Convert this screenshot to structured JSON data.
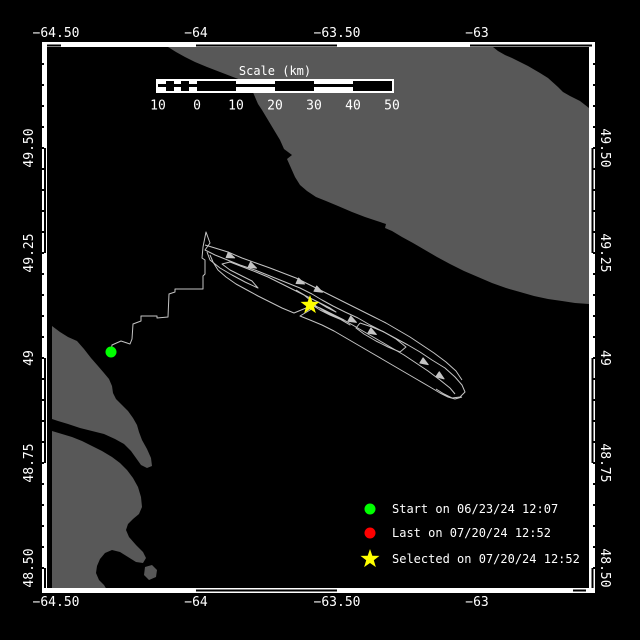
{
  "colors": {
    "background": "#000000",
    "sea": "#000000",
    "land": "#585858",
    "frame": "#ffffff",
    "track": "#c4c4c4",
    "text": "#ffffff",
    "start_marker": "#00ff00",
    "last_marker": "#ff0000",
    "selected_marker": "#ffff00"
  },
  "axes": {
    "top": [
      {
        "label": "−64.50",
        "x": 56
      },
      {
        "label": "−64",
        "x": 196
      },
      {
        "label": "−63.50",
        "x": 337
      },
      {
        "label": "−63",
        "x": 477
      }
    ],
    "bottom": [
      {
        "label": "−64.50",
        "x": 56
      },
      {
        "label": "−64",
        "x": 196
      },
      {
        "label": "−63.50",
        "x": 337
      },
      {
        "label": "−63",
        "x": 477
      }
    ],
    "left": [
      {
        "label": "49.50",
        "y": 148
      },
      {
        "label": "49.25",
        "y": 253
      },
      {
        "label": "49",
        "y": 358
      },
      {
        "label": "48.75",
        "y": 463
      },
      {
        "label": "48.50",
        "y": 568
      }
    ],
    "right": [
      {
        "label": "49.50",
        "y": 148
      },
      {
        "label": "49.25",
        "y": 253
      },
      {
        "label": "49",
        "y": 358
      },
      {
        "label": "48.75",
        "y": 463
      },
      {
        "label": "48.50",
        "y": 568
      }
    ]
  },
  "scale_bar": {
    "title": "Scale (km)",
    "labels": [
      {
        "text": "10",
        "km": -10
      },
      {
        "text": "0",
        "km": 0
      },
      {
        "text": "10",
        "km": 10
      },
      {
        "text": "20",
        "km": 20
      },
      {
        "text": "30",
        "km": 30
      },
      {
        "text": "40",
        "km": 40
      },
      {
        "text": "50",
        "km": 50
      }
    ],
    "segments": [
      {
        "km": 2,
        "fill": "striped"
      },
      {
        "km": 2,
        "fill": "black"
      },
      {
        "km": 2,
        "fill": "striped"
      },
      {
        "km": 2,
        "fill": "black"
      },
      {
        "km": 2,
        "fill": "striped"
      },
      {
        "km": 10,
        "fill": "black"
      },
      {
        "km": 10,
        "fill": "striped"
      },
      {
        "km": 10,
        "fill": "black"
      },
      {
        "km": 10,
        "fill": "striped"
      },
      {
        "km": 10,
        "fill": "black"
      }
    ]
  },
  "legend": {
    "items": [
      {
        "marker": "circle",
        "color": "#00ff00",
        "label": "Start on 06/23/24 12:07"
      },
      {
        "marker": "circle",
        "color": "#ff0000",
        "label": "Last on 07/20/24 12:52"
      },
      {
        "marker": "star",
        "color": "#ffff00",
        "label": "Selected on 07/20/24 12:52"
      }
    ]
  },
  "map_data": {
    "land_polygons": [
      [
        [
          168,
          47
        ],
        [
          176,
          52
        ],
        [
          185,
          57
        ],
        [
          195,
          62
        ],
        [
          207,
          67
        ],
        [
          220,
          72
        ],
        [
          233,
          77
        ],
        [
          241,
          80
        ],
        [
          248,
          84
        ],
        [
          252,
          90
        ],
        [
          255,
          97
        ],
        [
          258,
          104
        ],
        [
          262,
          110
        ],
        [
          268,
          120
        ],
        [
          274,
          130
        ],
        [
          280,
          140
        ],
        [
          284,
          149
        ],
        [
          292,
          155
        ],
        [
          287,
          159
        ],
        [
          291,
          168
        ],
        [
          295,
          177
        ],
        [
          300,
          185
        ],
        [
          307,
          191
        ],
        [
          316,
          197
        ],
        [
          326,
          201
        ],
        [
          338,
          206
        ],
        [
          352,
          212
        ],
        [
          365,
          217
        ],
        [
          377,
          221
        ],
        [
          386,
          224
        ],
        [
          385,
          228
        ],
        [
          392,
          231
        ],
        [
          402,
          237
        ],
        [
          413,
          243
        ],
        [
          425,
          250
        ],
        [
          437,
          257
        ],
        [
          450,
          264
        ],
        [
          464,
          271
        ],
        [
          478,
          277
        ],
        [
          492,
          283
        ],
        [
          506,
          288
        ],
        [
          520,
          292
        ],
        [
          534,
          296
        ],
        [
          548,
          299
        ],
        [
          562,
          301
        ],
        [
          575,
          303
        ],
        [
          589,
          304
        ],
        [
          589,
          108
        ],
        [
          580,
          101
        ],
        [
          570,
          96
        ],
        [
          563,
          92
        ],
        [
          558,
          87
        ],
        [
          548,
          78
        ],
        [
          540,
          73
        ],
        [
          528,
          66
        ],
        [
          520,
          62
        ],
        [
          512,
          58
        ],
        [
          505,
          55
        ],
        [
          498,
          51
        ],
        [
          493,
          47
        ]
      ],
      [
        [
          52,
          326
        ],
        [
          60,
          332
        ],
        [
          68,
          337
        ],
        [
          77,
          341
        ],
        [
          84,
          349
        ],
        [
          91,
          358
        ],
        [
          98,
          366
        ],
        [
          104,
          373
        ],
        [
          109,
          379
        ],
        [
          112,
          386
        ],
        [
          113,
          393
        ],
        [
          116,
          399
        ],
        [
          122,
          405
        ],
        [
          128,
          411
        ],
        [
          133,
          418
        ],
        [
          137,
          425
        ],
        [
          139,
          432
        ],
        [
          142,
          440
        ],
        [
          147,
          449
        ],
        [
          151,
          458
        ],
        [
          152,
          466
        ],
        [
          147,
          468
        ],
        [
          141,
          465
        ],
        [
          136,
          458
        ],
        [
          131,
          451
        ],
        [
          124,
          444
        ],
        [
          115,
          439
        ],
        [
          104,
          434
        ],
        [
          92,
          431
        ],
        [
          80,
          428
        ],
        [
          68,
          424
        ],
        [
          58,
          421
        ],
        [
          52,
          419
        ]
      ],
      [
        [
          52,
          431
        ],
        [
          62,
          434
        ],
        [
          72,
          437
        ],
        [
          82,
          441
        ],
        [
          92,
          446
        ],
        [
          102,
          451
        ],
        [
          112,
          457
        ],
        [
          120,
          463
        ],
        [
          127,
          470
        ],
        [
          133,
          478
        ],
        [
          138,
          487
        ],
        [
          141,
          497
        ],
        [
          142,
          507
        ],
        [
          139,
          514
        ],
        [
          133,
          519
        ],
        [
          128,
          524
        ],
        [
          126,
          530
        ],
        [
          129,
          537
        ],
        [
          136,
          545
        ],
        [
          143,
          552
        ],
        [
          146,
          558
        ],
        [
          143,
          563
        ],
        [
          136,
          562
        ],
        [
          128,
          557
        ],
        [
          120,
          552
        ],
        [
          112,
          550
        ],
        [
          105,
          553
        ],
        [
          100,
          559
        ],
        [
          97,
          566
        ],
        [
          96,
          573
        ],
        [
          99,
          580
        ],
        [
          104,
          585
        ],
        [
          107,
          590
        ],
        [
          52,
          590
        ]
      ],
      [
        [
          145,
          567
        ],
        [
          152,
          565
        ],
        [
          157,
          570
        ],
        [
          156,
          577
        ],
        [
          149,
          580
        ],
        [
          144,
          575
        ]
      ]
    ],
    "track_lines": [
      [
        [
          111,
          352
        ],
        [
          112,
          345
        ],
        [
          121,
          341
        ],
        [
          130,
          344
        ],
        [
          132,
          339
        ],
        [
          133,
          324
        ],
        [
          141,
          321
        ],
        [
          141,
          316
        ],
        [
          157,
          316
        ],
        [
          157,
          318
        ],
        [
          168,
          317
        ],
        [
          169,
          294
        ],
        [
          175,
          292
        ],
        [
          175,
          289
        ],
        [
          203,
          289
        ],
        [
          203,
          276
        ],
        [
          205,
          274
        ],
        [
          205,
          260
        ],
        [
          202,
          258
        ],
        [
          203,
          247
        ],
        [
          206,
          232
        ],
        [
          210,
          243
        ],
        [
          205,
          250
        ],
        [
          215,
          255
        ],
        [
          225,
          259
        ],
        [
          240,
          265
        ],
        [
          255,
          270
        ],
        [
          270,
          276
        ],
        [
          285,
          282
        ],
        [
          300,
          288
        ],
        [
          312,
          294
        ],
        [
          322,
          300
        ],
        [
          333,
          306
        ],
        [
          345,
          312
        ],
        [
          358,
          318
        ],
        [
          370,
          325
        ],
        [
          382,
          331
        ],
        [
          395,
          338
        ],
        [
          408,
          345
        ],
        [
          420,
          352
        ],
        [
          432,
          360
        ],
        [
          445,
          368
        ],
        [
          455,
          377
        ],
        [
          462,
          385
        ],
        [
          465,
          392
        ],
        [
          460,
          397
        ],
        [
          452,
          398
        ],
        [
          444,
          394
        ],
        [
          436,
          389
        ]
      ],
      [
        [
          205,
          245
        ],
        [
          215,
          248
        ],
        [
          228,
          252
        ],
        [
          242,
          258
        ],
        [
          256,
          263
        ],
        [
          270,
          268
        ],
        [
          283,
          273
        ],
        [
          296,
          278
        ],
        [
          308,
          284
        ],
        [
          318,
          289
        ],
        [
          328,
          294
        ],
        [
          338,
          299
        ],
        [
          350,
          305
        ],
        [
          362,
          311
        ],
        [
          374,
          317
        ],
        [
          386,
          323
        ],
        [
          398,
          330
        ],
        [
          410,
          337
        ],
        [
          422,
          345
        ],
        [
          434,
          353
        ],
        [
          446,
          362
        ],
        [
          456,
          371
        ],
        [
          462,
          380
        ]
      ],
      [
        [
          207,
          252
        ],
        [
          210,
          260
        ],
        [
          220,
          268
        ],
        [
          232,
          275
        ],
        [
          245,
          282
        ],
        [
          258,
          288
        ],
        [
          252,
          281
        ],
        [
          240,
          275
        ],
        [
          230,
          270
        ],
        [
          222,
          264
        ],
        [
          230,
          262
        ],
        [
          243,
          267
        ],
        [
          256,
          272
        ],
        [
          268,
          277
        ],
        [
          280,
          283
        ],
        [
          292,
          289
        ],
        [
          304,
          295
        ],
        [
          310,
          300
        ],
        [
          316,
          306
        ],
        [
          326,
          312
        ],
        [
          338,
          318
        ],
        [
          350,
          325
        ],
        [
          342,
          320
        ],
        [
          330,
          315
        ],
        [
          320,
          310
        ],
        [
          312,
          305
        ],
        [
          320,
          308
        ],
        [
          332,
          314
        ],
        [
          344,
          320
        ],
        [
          356,
          327
        ],
        [
          368,
          334
        ],
        [
          380,
          341
        ],
        [
          392,
          348
        ],
        [
          404,
          355
        ],
        [
          416,
          363
        ],
        [
          428,
          371
        ],
        [
          440,
          380
        ],
        [
          450,
          388
        ],
        [
          455,
          394
        ]
      ],
      [
        [
          210,
          255
        ],
        [
          213,
          262
        ],
        [
          218,
          270
        ],
        [
          226,
          277
        ],
        [
          236,
          284
        ],
        [
          247,
          290
        ],
        [
          258,
          296
        ],
        [
          270,
          302
        ],
        [
          282,
          308
        ],
        [
          294,
          313
        ],
        [
          306,
          308
        ],
        [
          316,
          303
        ],
        [
          310,
          310
        ],
        [
          300,
          316
        ],
        [
          310,
          320
        ],
        [
          322,
          325
        ],
        [
          334,
          331
        ],
        [
          346,
          338
        ],
        [
          358,
          345
        ],
        [
          370,
          352
        ],
        [
          382,
          359
        ],
        [
          394,
          366
        ],
        [
          406,
          373
        ],
        [
          418,
          380
        ],
        [
          430,
          387
        ],
        [
          440,
          393
        ],
        [
          448,
          397
        ],
        [
          455,
          399
        ],
        [
          462,
          397
        ]
      ],
      [
        [
          360,
          323
        ],
        [
          372,
          327
        ],
        [
          384,
          332
        ],
        [
          396,
          339
        ],
        [
          406,
          347
        ],
        [
          400,
          352
        ],
        [
          388,
          347
        ],
        [
          376,
          341
        ],
        [
          364,
          334
        ],
        [
          356,
          328
        ],
        [
          360,
          323
        ]
      ],
      [
        [
          296,
          290
        ],
        [
          306,
          296
        ],
        [
          316,
          301
        ],
        [
          326,
          307
        ],
        [
          336,
          312
        ],
        [
          330,
          308
        ],
        [
          320,
          303
        ],
        [
          310,
          298
        ]
      ]
    ],
    "arrows": [
      {
        "x": 252,
        "y": 266,
        "a": 25
      },
      {
        "x": 318,
        "y": 290,
        "a": 27
      },
      {
        "x": 372,
        "y": 332,
        "a": 30
      },
      {
        "x": 424,
        "y": 362,
        "a": 32
      },
      {
        "x": 300,
        "y": 282,
        "a": 24
      },
      {
        "x": 352,
        "y": 320,
        "a": 28
      },
      {
        "x": 440,
        "y": 376,
        "a": 35
      },
      {
        "x": 230,
        "y": 256,
        "a": 22
      }
    ],
    "markers": [
      {
        "type": "circle",
        "color": "#00ff00",
        "x": 111,
        "y": 352,
        "r": 5.5,
        "name": "start-marker"
      },
      {
        "type": "star",
        "color": "#ffff00",
        "x": 310,
        "y": 305,
        "R": 10,
        "r": 4,
        "name": "selected-marker"
      }
    ]
  }
}
